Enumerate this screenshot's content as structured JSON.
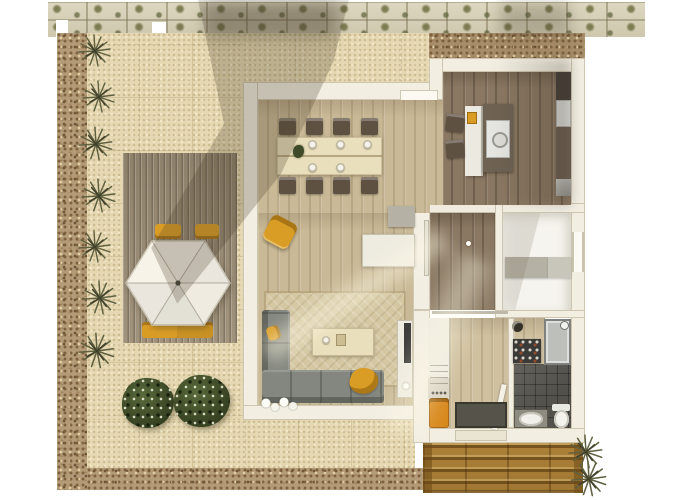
{
  "scene": {
    "kind": "architectural-floor-plan-top-view",
    "rooms": [
      "terrace-garden",
      "dining-living-area",
      "kitchen",
      "hallway",
      "bedroom",
      "entry",
      "bathroom",
      "porch"
    ],
    "visible_text": []
  },
  "palette": {
    "background": "#ffffff",
    "paver": "#d9d2b7",
    "gravel": "#b49b77",
    "gravelDark": "#a78d69",
    "sand": "#e5d8b2",
    "deck": "#9a8c75",
    "porch": "#b5873a",
    "wall": "#f2eee2",
    "floorLight": "#c9b996",
    "floorDark": "#8a7862",
    "floorEntry": "#cfc0a0",
    "floorBedroom": "#f6f4ee",
    "tile": "#53514b",
    "shower": "#bdbfba",
    "umbrella": "#f6f2e8",
    "yellow": "#d99d26",
    "orange": "#d8891d",
    "green": "#3e4a28",
    "sofa": "#84877f",
    "rug": "#d4c7a2",
    "table": "#e9dfbc",
    "chair": "#5e5142",
    "counter": "#6e6253",
    "counterTall": "#474139",
    "island": "#ece9e1",
    "unitWhite": "#eeebe0",
    "appliance": "#e6e6e2",
    "fridge": "#dedfda",
    "grayFurn": "#b5b1a4",
    "grayFurnLight": "#c8c5ba",
    "mat": "#56534a",
    "tv": "#3a3a38",
    "sill": "#eae4d3"
  },
  "objects": {
    "plan": "apartment floor plan rendering",
    "umbrella": "hexagonal patio umbrella",
    "deck": "wooden terrace deck",
    "loungers": "yellow sun loungers",
    "bushes": "garden shrubs",
    "diningTable": "dining table with eight chairs",
    "armchair": "yellow armchair",
    "sofa": "corner sofa",
    "coffeeTable": "coffee table",
    "tvUnit": "tv cabinet",
    "island": "kitchen island",
    "stove": "cooktop",
    "fridge": "refrigerator counter",
    "dresser": "bedroom dresser",
    "washer": "laundry unit",
    "doormat": "entry doormat",
    "shoeRack": "shoe rack",
    "shower": "shower cabin",
    "toilet": "toilet",
    "sink": "bathroom sink",
    "porch": "entry porch deck",
    "grass": "ornamental grass",
    "flowers": "white flowers"
  }
}
